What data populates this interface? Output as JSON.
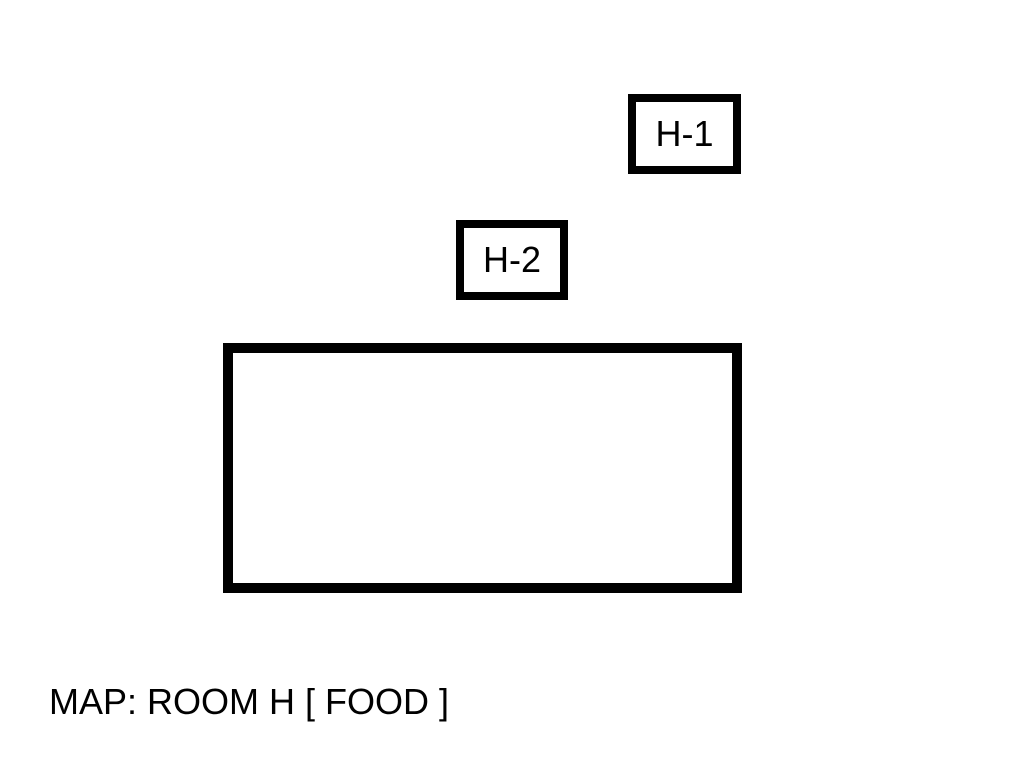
{
  "map": {
    "title": "MAP: ROOM H [ FOOD ]",
    "rooms": [
      {
        "id": "H-1",
        "label": "H-1",
        "kind": "small-room"
      },
      {
        "id": "H-2",
        "label": "H-2",
        "kind": "small-room"
      },
      {
        "id": "main",
        "label": "",
        "kind": "large-room"
      }
    ],
    "colors": {
      "foreground": "#000000",
      "background": "#ffffff"
    }
  }
}
